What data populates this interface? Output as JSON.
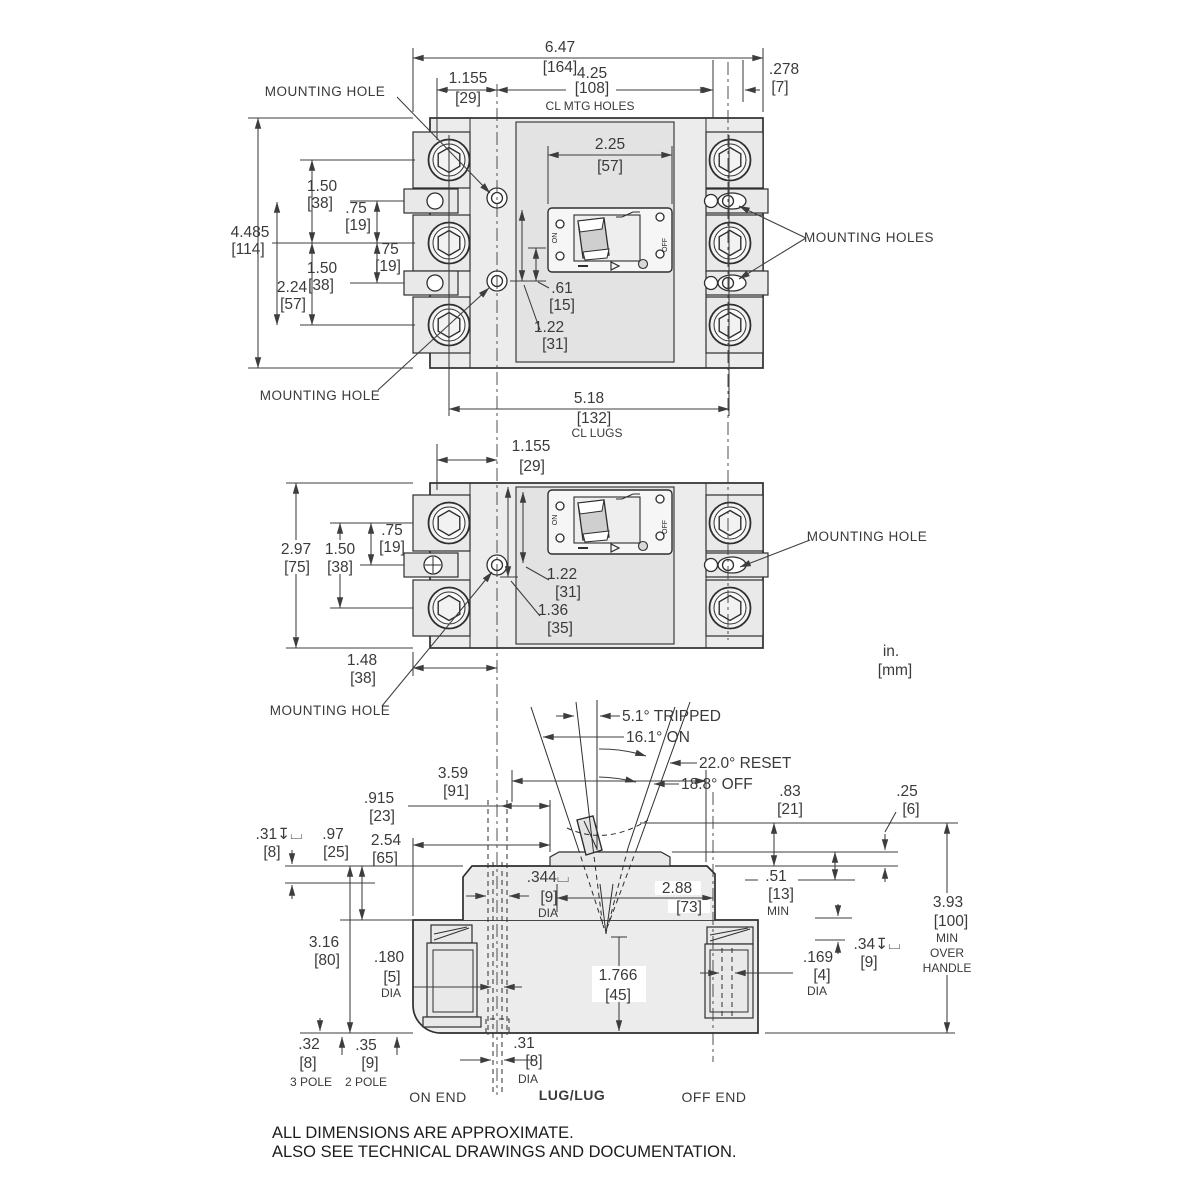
{
  "units": {
    "inch": "in.",
    "mm": "[mm]"
  },
  "footer": [
    "ALL DIMENSIONS ARE APPROXIMATE.",
    "ALSO SEE TECHNICAL DRAWINGS AND DOCUMENTATION."
  ],
  "labels": {
    "mounting_hole": "MOUNTING HOLE",
    "mounting_holes": "MOUNTING HOLES",
    "cl_mtg": "CL MTG HOLES",
    "cl_lugs": "CL LUGS",
    "dia": "DIA",
    "min": "MIN",
    "over": "OVER",
    "handle": "HANDLE",
    "on_end": "ON END",
    "lug_lug": "LUG/LUG",
    "off_end": "OFF END",
    "pole3": "3 POLE",
    "pole2": "2 POLE"
  },
  "face": {
    "on": "ON",
    "off": "OFF"
  },
  "angles": {
    "tripped": "5.1°  TRIPPED",
    "on": "16.1°  ON",
    "reset": "22.0°  RESET",
    "off": "18.8°  OFF"
  },
  "front3": {
    "overall_w": {
      "in": "6.47",
      "mm": "[164]"
    },
    "hole_off": {
      "in": "1.155",
      "mm": "[29]"
    },
    "mtg_span": {
      "in": "4.25",
      "mm": "[108]"
    },
    "edge": {
      "in": ".278",
      "mm": "[7]"
    },
    "face_w": {
      "in": "2.25",
      "mm": "[57]"
    },
    "pitch_a": {
      "in": "1.50",
      "mm": "[38]"
    },
    "tab_a": {
      "in": ".75",
      "mm": "[19]"
    },
    "overall_h": {
      "in": "4.485",
      "mm": "[114]"
    },
    "tab_b": {
      "in": ".75",
      "mm": "[19]"
    },
    "pitch_b": {
      "in": "1.50",
      "mm": "[38]"
    },
    "hole_span": {
      "in": "2.24",
      "mm": "[57]"
    },
    "d61": {
      "in": ".61",
      "mm": "[15]"
    },
    "d122": {
      "in": "1.22",
      "mm": "[31]"
    },
    "lug_span": {
      "in": "5.18",
      "mm": "[132]"
    }
  },
  "front2": {
    "hole_off": {
      "in": "1.155",
      "mm": "[29]"
    },
    "overall_h": {
      "in": "2.97",
      "mm": "[75]"
    },
    "pitch": {
      "in": "1.50",
      "mm": "[38]"
    },
    "tab": {
      "in": ".75",
      "mm": "[19]"
    },
    "d122": {
      "in": "1.22",
      "mm": "[31]"
    },
    "d136": {
      "in": "1.36",
      "mm": "[35]"
    },
    "d148": {
      "in": "1.48",
      "mm": "[38]"
    }
  },
  "side": {
    "d359": {
      "in": "3.59",
      "mm": "[91]"
    },
    "d915": {
      "in": ".915",
      "mm": "[23]"
    },
    "d254": {
      "in": "2.54",
      "mm": "[65]"
    },
    "d31cb": {
      "in": ".31↧⌴",
      "mm": "[8]"
    },
    "d97": {
      "in": ".97",
      "mm": "[25]"
    },
    "d83": {
      "in": ".83",
      "mm": "[21]"
    },
    "d25": {
      "in": ".25",
      "mm": "[6]"
    },
    "d344": {
      "in": ".344⌴",
      "mm": "[9]"
    },
    "d288": {
      "in": "2.88",
      "mm": "[73]"
    },
    "d51": {
      "in": ".51",
      "mm": "[13]"
    },
    "d393": {
      "in": "3.93",
      "mm": "[100]"
    },
    "d316": {
      "in": "3.16",
      "mm": "[80]"
    },
    "d180": {
      "in": ".180",
      "mm": "[5]"
    },
    "d1766": {
      "in": "1.766",
      "mm": "[45]"
    },
    "d34cb": {
      "in": ".34↧⌴",
      "mm": "[9]"
    },
    "d169": {
      "in": ".169",
      "mm": "[4]"
    },
    "d32": {
      "in": ".32",
      "mm": "[8]"
    },
    "d35": {
      "in": ".35",
      "mm": "[9]"
    },
    "d31": {
      "in": ".31",
      "mm": "[8]"
    }
  }
}
